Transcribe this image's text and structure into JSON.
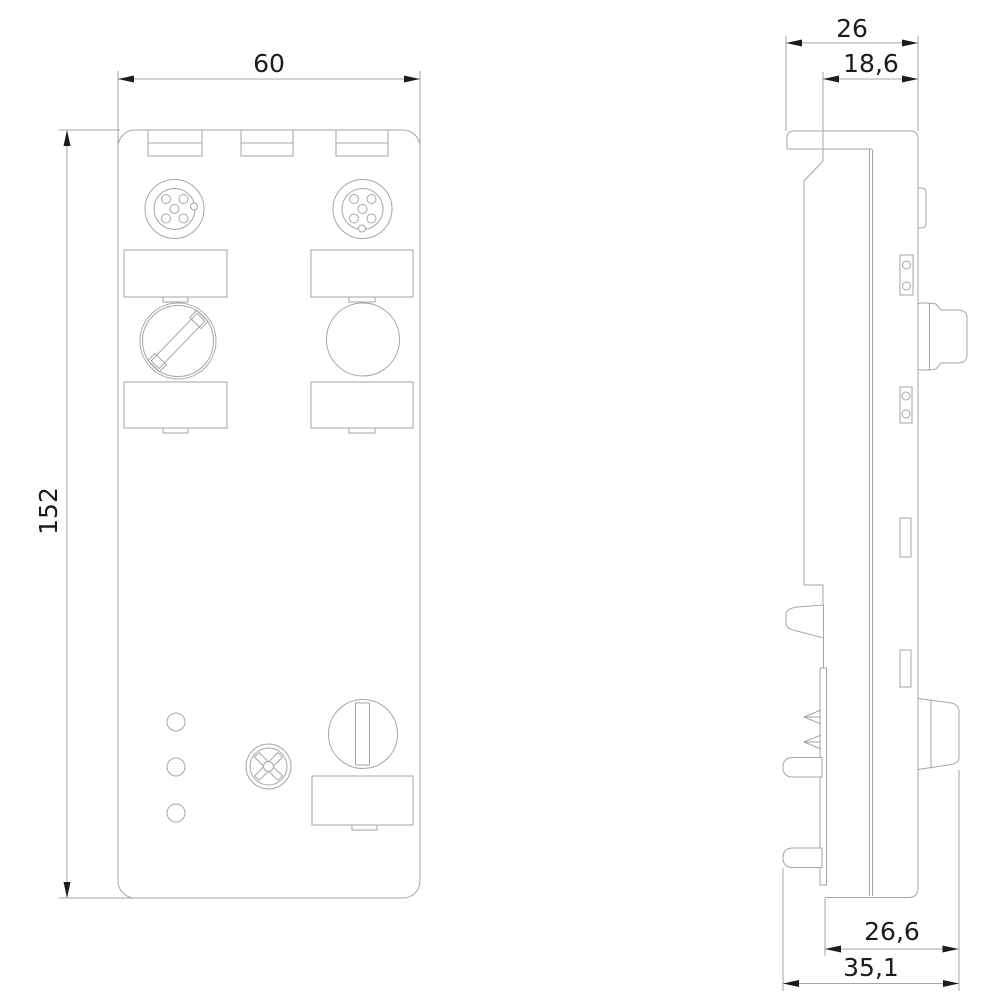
{
  "drawing": {
    "description": "Two-view dimensional line drawing of a compact fieldbus I/O module: front view on the left, side profile view on the right, with millimetre dimensions",
    "front_view": {
      "dimensions": {
        "width": "60",
        "height": "152"
      },
      "features": [
        "mounting-notches",
        "m12-socket-left",
        "m12-socket-right",
        "label-fields",
        "sealing-screw-slotted",
        "sealing-cap-plain",
        "led-indicators",
        "phillips-screw",
        "addressing-switch",
        "address-label-field"
      ]
    },
    "side_view": {
      "dimensions": {
        "top_flange_depth": "26",
        "housing_depth": "18,6",
        "depth_with_connector": "26,6",
        "overall_depth": "35,1"
      },
      "features": [
        "top-flange",
        "side-bump",
        "clamp-contacts",
        "m12-connector-profile",
        "vent-slots",
        "addressing-socket-profile",
        "din-rail-latch",
        "contact-springs",
        "rear-pins"
      ]
    },
    "colors": {
      "background": "#ffffff",
      "outline": "#a6a6a6",
      "dimension": "#1c1c1c"
    }
  }
}
